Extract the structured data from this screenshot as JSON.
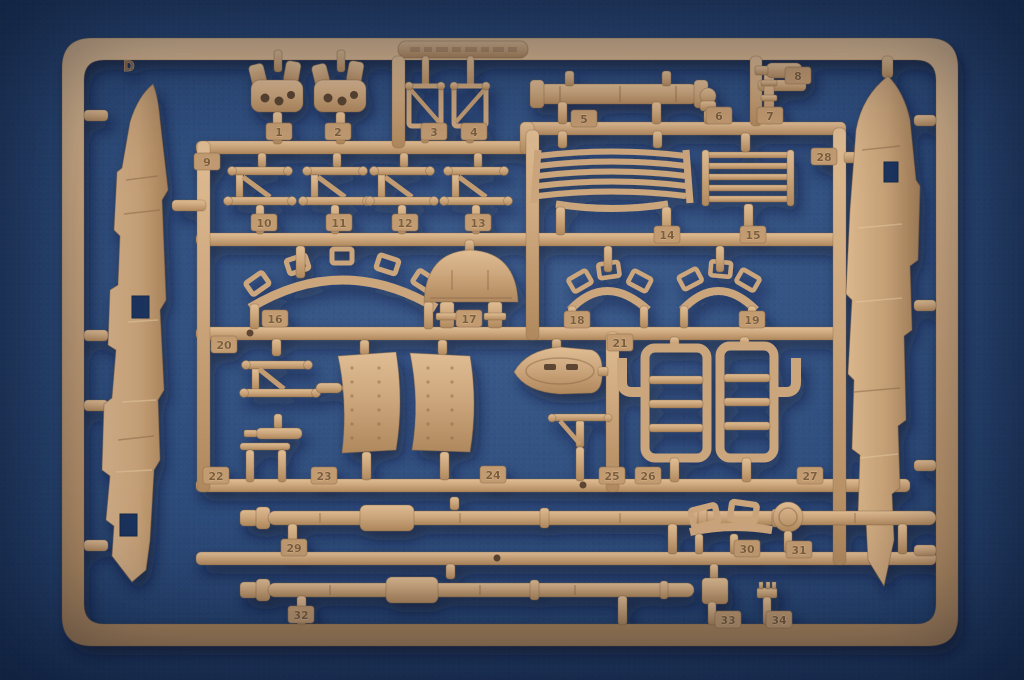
{
  "scene": {
    "type": "photograph",
    "subject": "Tan injection-molded plastic model kit sprue (runner D, parts 1-34) photographed on a blue felt background",
    "background_color": "#2f4e7e",
    "plastic_color": "#cda77d"
  },
  "sprue": {
    "letter": "D",
    "tags": [
      "1",
      "2",
      "3",
      "4",
      "5",
      "6",
      "7",
      "8",
      "9",
      "10",
      "11",
      "12",
      "13",
      "14",
      "15",
      "16",
      "17",
      "18",
      "19",
      "20",
      "21",
      "22",
      "23",
      "24",
      "25",
      "26",
      "27",
      "28",
      "29",
      "30",
      "31",
      "32",
      "33",
      "34"
    ]
  }
}
